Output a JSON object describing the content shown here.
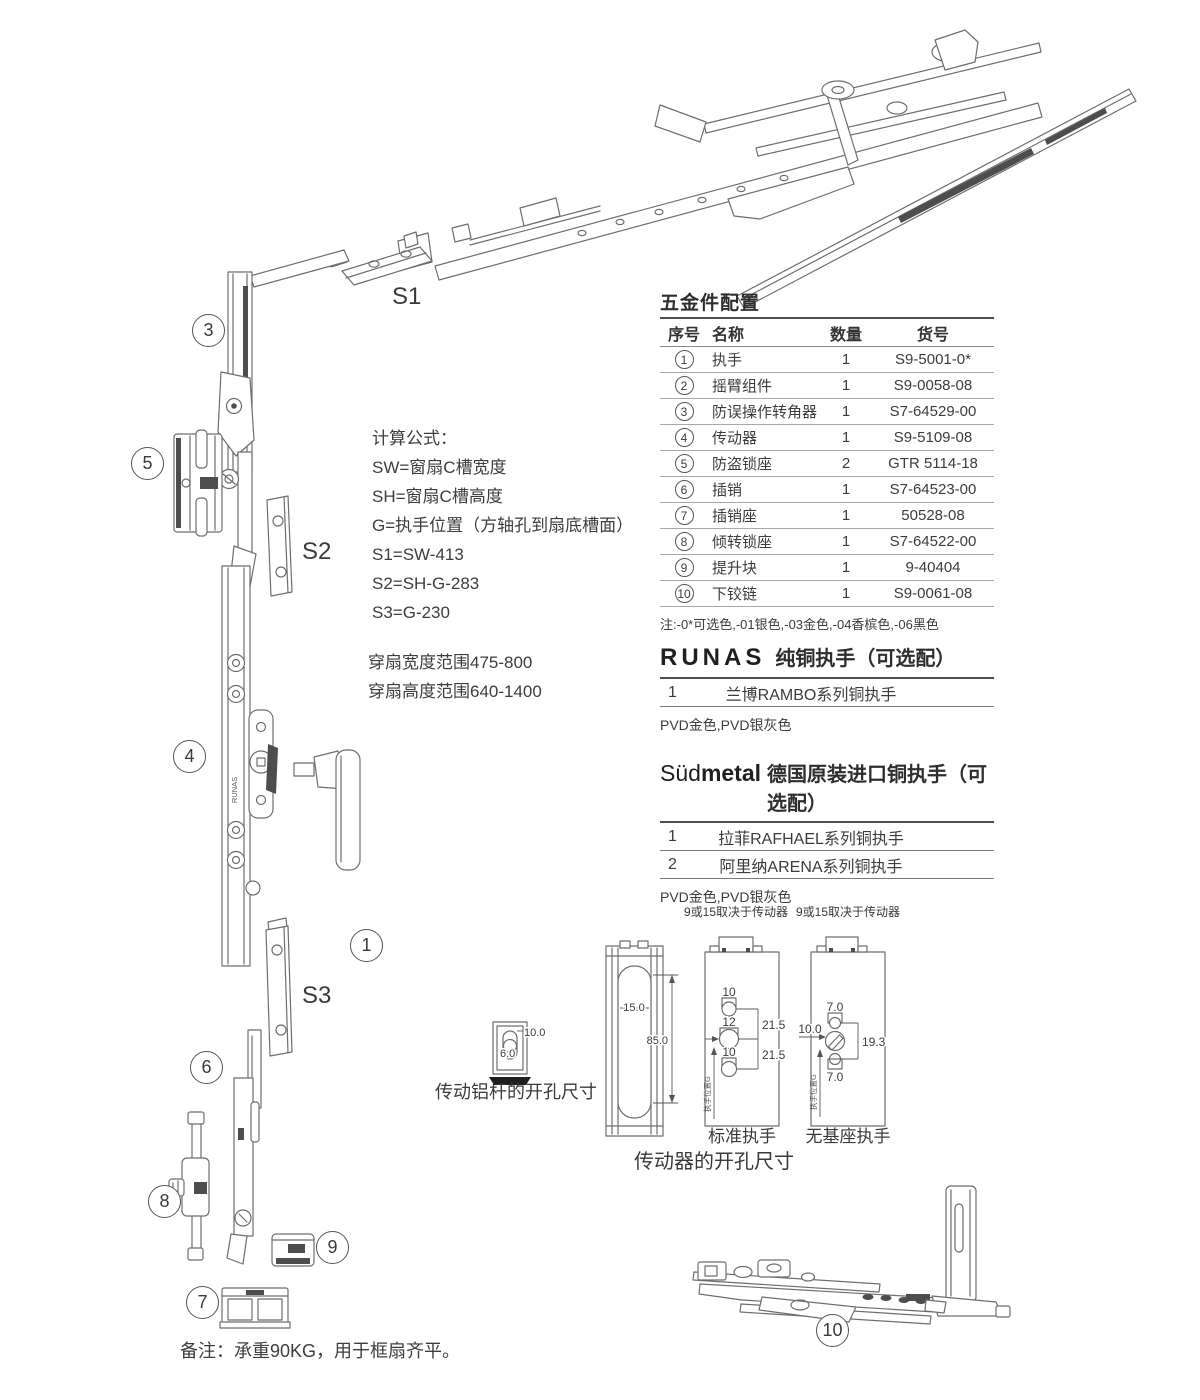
{
  "diagram": {
    "bar_brand": "RUNAS",
    "balloons": {
      "b1": "1",
      "b3": "3",
      "b4": "4",
      "b5": "5",
      "b6": "6",
      "b7": "7",
      "b8": "8",
      "b9": "9",
      "b10": "10"
    },
    "part_labels": {
      "s1": "S1",
      "s2": "S2",
      "s3": "S3"
    }
  },
  "formulas": {
    "title": "计算公式：",
    "lines": [
      "SW=窗扇C槽宽度",
      "SH=窗扇C槽高度",
      "G=执手位置（方轴孔到扇底槽面）",
      "S1=SW-413",
      "S2=SH-G-283",
      "S3=G-230"
    ]
  },
  "ranges": {
    "line1": "穿扇宽度范围475-800",
    "line2": "穿扇高度范围640-1400"
  },
  "hardware_table": {
    "title": "五金件配置",
    "headers": [
      "序号",
      "名称",
      "数量",
      "货号"
    ],
    "rows": [
      {
        "no": "1",
        "name": "执手",
        "qty": "1",
        "code": "S9-5001-0*"
      },
      {
        "no": "2",
        "name": "摇臂组件",
        "qty": "1",
        "code": "S9-0058-08"
      },
      {
        "no": "3",
        "name": "防误操作转角器",
        "qty": "1",
        "code": "S7-64529-00"
      },
      {
        "no": "4",
        "name": "传动器",
        "qty": "1",
        "code": "S9-5109-08"
      },
      {
        "no": "5",
        "name": "防盗锁座",
        "qty": "2",
        "code": "GTR 5114-18"
      },
      {
        "no": "6",
        "name": "插销",
        "qty": "1",
        "code": "S7-64523-00"
      },
      {
        "no": "7",
        "name": "插销座",
        "qty": "1",
        "code": "50528-08"
      },
      {
        "no": "8",
        "name": "倾转锁座",
        "qty": "1",
        "code": "S7-64522-00"
      },
      {
        "no": "9",
        "name": "提升块",
        "qty": "1",
        "code": "9-40404"
      },
      {
        "no": "10",
        "name": "下铰链",
        "qty": "1",
        "code": "S9-0061-08"
      }
    ],
    "note": "注:-0*可选色,-01银色,-03金色,-04香槟色,-06黑色"
  },
  "runas_section": {
    "brand": "RUNAS",
    "title": "纯铜执手（可选配）",
    "rows": [
      {
        "no": "1",
        "name": "兰博RAMBO系列铜执手"
      }
    ],
    "finish": "PVD金色,PVD银灰色"
  },
  "sudmetal_section": {
    "brand_light": "Süd",
    "brand_bold": "metal",
    "title": "德国原装进口铜执手（可选配）",
    "rows": [
      {
        "no": "1",
        "name": "拉菲RAFHAEL系列铜执手"
      },
      {
        "no": "2",
        "name": "阿里纳ARENA系列铜执手"
      }
    ],
    "finish": "PVD金色,PVD银灰色"
  },
  "dims": {
    "rod": {
      "d_width": "10.0",
      "d_height": "6.0",
      "label": "传动铝杆的开孔尺寸"
    },
    "profile": {
      "d_slot": "15.0",
      "d_length": "85.0"
    },
    "standard": {
      "top_note": "9或15取决于传动器",
      "hole_top": "10",
      "hole_mid": "12",
      "hole_bottom": "10",
      "pitch_top": "21.5",
      "pitch_bottom": "21.5",
      "axis": "执手位置G",
      "label": "标准执手"
    },
    "nobase": {
      "top_note": "9或15取决于传动器",
      "hole_top": "7.0",
      "hole_left": "10.0",
      "pitch": "19.3",
      "hole_bottom": "7.0",
      "axis": "执手位置G",
      "label": "无基座执手"
    },
    "section_label": "传动器的开孔尺寸"
  },
  "page": {
    "bottom_note": "备注：承重90KG，用于框扇齐平。"
  }
}
